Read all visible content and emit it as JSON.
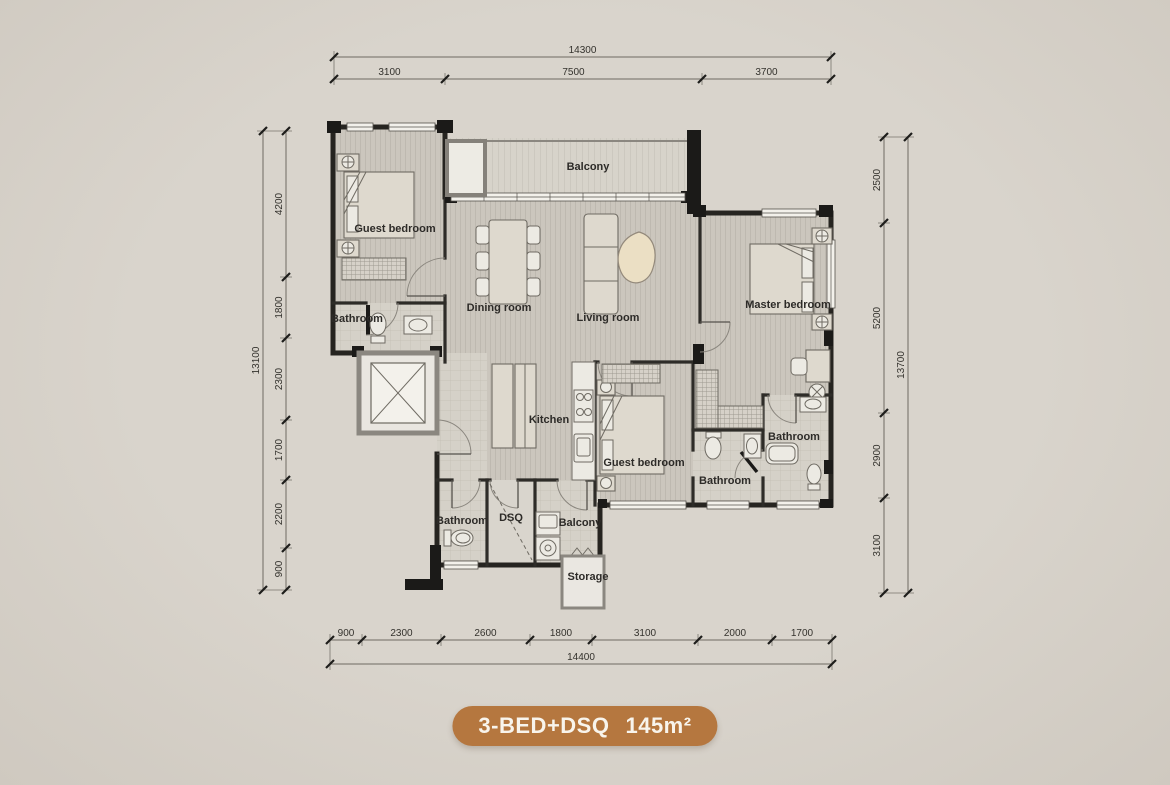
{
  "canvas": {
    "width": 1170,
    "height": 785
  },
  "colors": {
    "accent": "#b5773f",
    "background": "#d7d2ca",
    "wall": "#262420",
    "floor": "#cbc6bd",
    "label_text": "#2d2b28"
  },
  "badge": {
    "name": "3-BED+DSQ",
    "area": "145m²"
  },
  "plan": {
    "rooms": [
      {
        "id": "guest-bedroom-1",
        "label": "Guest bedroom",
        "x": 395,
        "y": 232
      },
      {
        "id": "bathroom-1",
        "label": "Bathroom",
        "x": 357,
        "y": 322
      },
      {
        "id": "balcony-main",
        "label": "Balcony",
        "x": 588,
        "y": 170
      },
      {
        "id": "dining-room",
        "label": "Dining room",
        "x": 499,
        "y": 311
      },
      {
        "id": "living-room",
        "label": "Living room",
        "x": 608,
        "y": 321
      },
      {
        "id": "master-bedroom",
        "label": "Master bedroom",
        "x": 788,
        "y": 308
      },
      {
        "id": "kitchen",
        "label": "Kitchen",
        "x": 549,
        "y": 423
      },
      {
        "id": "guest-bedroom-2",
        "label": "Guest bedroom",
        "x": 644,
        "y": 466
      },
      {
        "id": "bathroom-2",
        "label": "Bathroom",
        "x": 725,
        "y": 484
      },
      {
        "id": "bathroom-3",
        "label": "Bathroom",
        "x": 794,
        "y": 440
      },
      {
        "id": "bathroom-4",
        "label": "Bathroom",
        "x": 462,
        "y": 524
      },
      {
        "id": "dsq",
        "label": "DSQ",
        "x": 511,
        "y": 521
      },
      {
        "id": "balcony-service",
        "label": "Balcony",
        "x": 580,
        "y": 526
      },
      {
        "id": "storage",
        "label": "Storage",
        "x": 588,
        "y": 580
      }
    ],
    "dimensions": {
      "top": {
        "orient": "h",
        "total": "14300",
        "segments": [
          "3100",
          "7500",
          "3700"
        ],
        "ticks": [
          334,
          445,
          702,
          831
        ],
        "seg_line": 79,
        "total_line": 57
      },
      "bottom": {
        "orient": "h",
        "total": "14400",
        "segments": [
          "900",
          "2300",
          "2600",
          "1800",
          "3100",
          "2000",
          "1700"
        ],
        "ticks": [
          330,
          362,
          441,
          530,
          592,
          698,
          772,
          832
        ],
        "seg_line": 640,
        "total_line": 664
      },
      "left": {
        "orient": "v",
        "total": "13100",
        "segments": [
          "4200",
          "1800",
          "2300",
          "1700",
          "2200",
          "900"
        ],
        "ticks": [
          131,
          277,
          338,
          420,
          480,
          548,
          590
        ],
        "seg_line": 286,
        "total_line": 263
      },
      "right": {
        "orient": "v",
        "total": "13700",
        "segments": [
          "2500",
          "5200",
          "2900",
          "3100"
        ],
        "ticks": [
          137,
          223,
          413,
          498,
          593
        ],
        "seg_line": 884,
        "total_line": 908
      }
    }
  }
}
